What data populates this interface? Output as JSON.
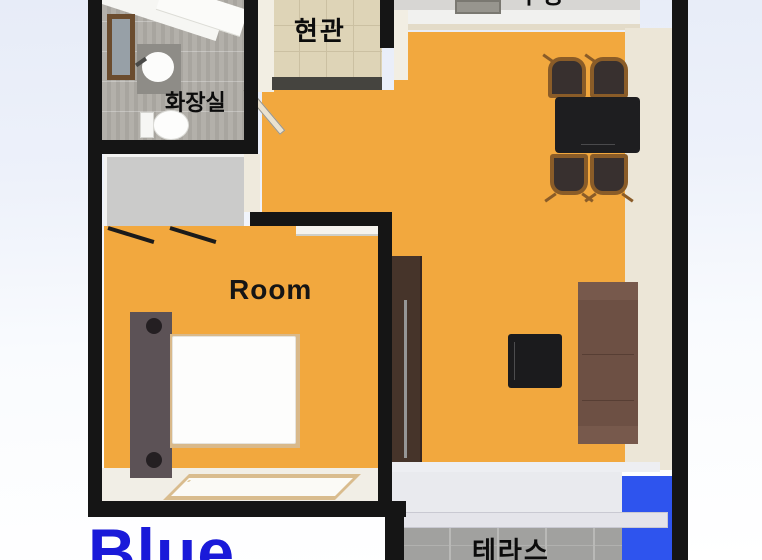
{
  "meta": {
    "type": "apartment floor plan (top-down 3D render)"
  },
  "labels": {
    "bathroom": "화장실",
    "entrance": "현관",
    "kitchen": "주방",
    "bedroom": "Room",
    "terrace": "테라스"
  },
  "branding": {
    "logo_text": "Blue"
  },
  "colors": {
    "floor_orange": "#f2a83e",
    "wall_black": "#151515",
    "terrace_highlight_blue": "#2e54ee",
    "logo_blue": "#1a1ad9"
  },
  "furniture_icons": [
    "mirror-cabinet-icon",
    "washbasin-icon",
    "toilet-icon",
    "wardrobe-icon",
    "bed-icon",
    "dining-table-icon",
    "dining-chair-icon",
    "tall-cabinet-icon",
    "coffee-table-icon",
    "sofa-icon",
    "sliding-glass-door-icon",
    "window-icon",
    "entrance-door-icon"
  ]
}
